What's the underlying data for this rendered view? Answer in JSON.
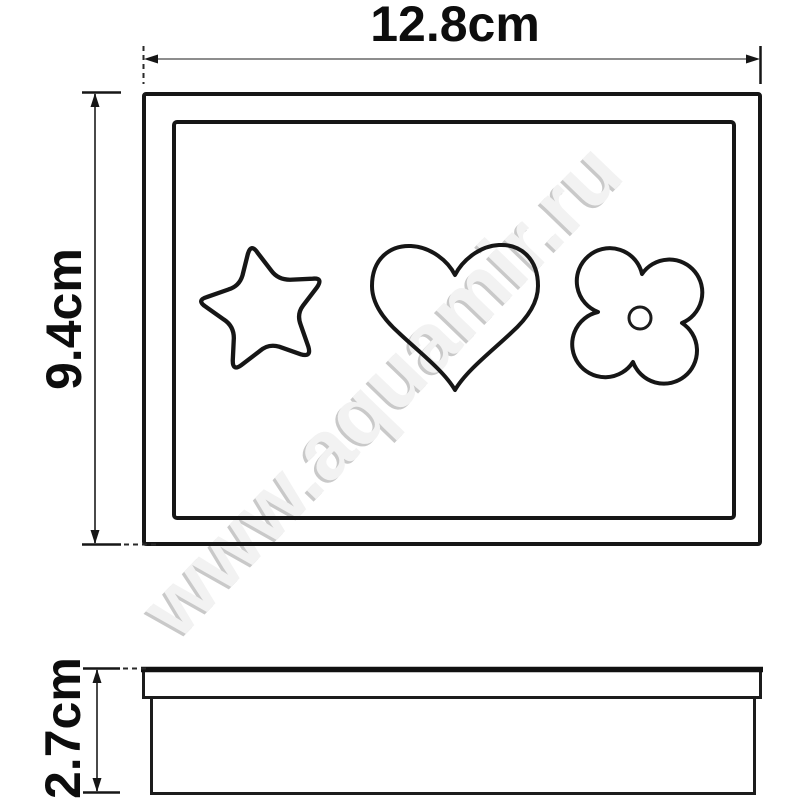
{
  "drawing": {
    "dimension_labels": {
      "width": "12.8cm",
      "height": "9.4cm",
      "depth": "2.7cm"
    },
    "watermark": {
      "text": "www.aquamir.ru"
    },
    "icons": [
      "star-icon",
      "heart-icon",
      "flower-icon"
    ],
    "colors": {
      "line": "#161616",
      "dimension_line": "#7d7d7d",
      "label_text": "#0d0d0d",
      "watermark_shadow": "#c9c9c9",
      "watermark_body": "#f2f2f2",
      "background": "#ffffff"
    }
  }
}
